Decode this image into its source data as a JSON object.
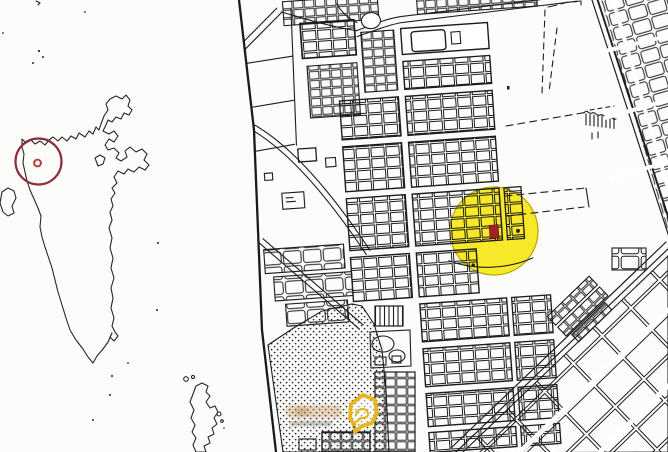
{
  "overview_map": {
    "kind": "island-archipelago-outline",
    "line_color": "#262626",
    "highlight": {
      "shape": "circle",
      "color": "#8e2d3a",
      "cx": 38.5,
      "cy": 161.5,
      "r": 23
    },
    "pin": {
      "shape": "ring",
      "color": "#c13c38",
      "cx": 37.5,
      "cy": 163,
      "r": 3.4
    }
  },
  "divider": {
    "color": "#1a1a1a"
  },
  "detail_map": {
    "kind": "cadastral-block-map",
    "line_color": "#1d1d1d",
    "highlight": {
      "shape": "circle",
      "fill": "#f6e504",
      "opacity": 0.85,
      "cx": 494,
      "cy": 231,
      "r": 44,
      "rim": "#b8a400"
    },
    "marker": {
      "shape": "rect",
      "fill": "#9f2127",
      "x": 489.5,
      "y": 225,
      "w": 9,
      "h": 13
    },
    "watermark": {
      "icon": "house-bubble-icon",
      "color": "#e9b51e"
    }
  }
}
